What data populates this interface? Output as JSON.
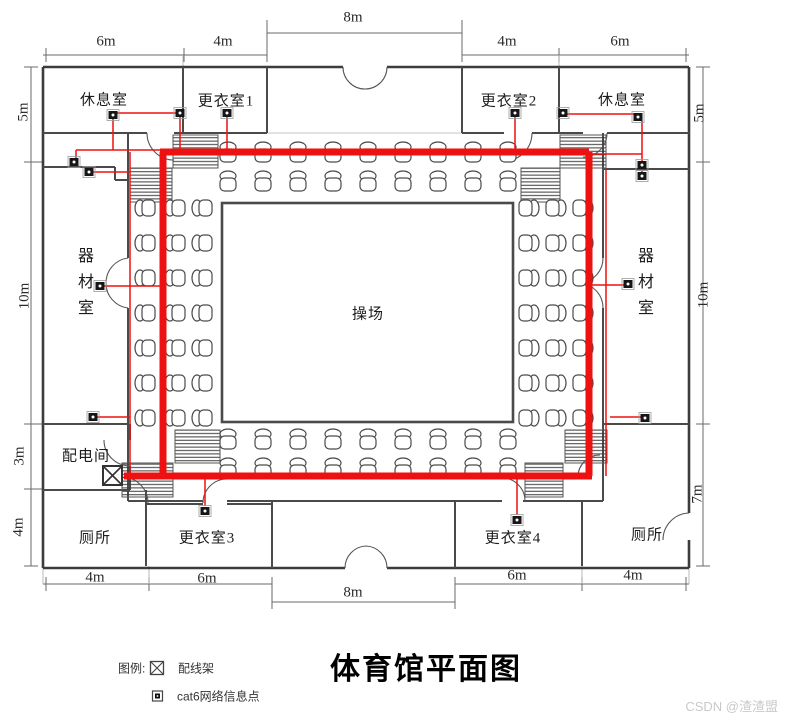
{
  "title": "体育馆平面图",
  "watermark": "CSDN @渣渣盟",
  "legend": {
    "heading": "图例:",
    "patch_panel_label": "配线架",
    "cat6_label": "cat6网络信息点"
  },
  "rooms": {
    "rest_room_tl": "休息室",
    "changing_room_1": "更衣室1",
    "changing_room_2": "更衣室2",
    "rest_room_tr": "休息室",
    "equipment_room_left": "器材室",
    "equipment_room_right": "器材室",
    "playground": "操场",
    "power_room": "配电间",
    "toilet_left": "厕所",
    "changing_room_3": "更衣室3",
    "changing_room_4": "更衣室4",
    "toilet_right": "厕所"
  },
  "dimensions": {
    "top_8m": "8m",
    "top_left_6m": "6m",
    "top_left_4m": "4m",
    "top_right_4m": "4m",
    "top_right_6m": "6m",
    "left_5m": "5m",
    "left_10m": "10m",
    "left_3m": "3m",
    "left_4m": "4m",
    "right_5m": "5m",
    "right_10m": "10m",
    "right_7m": "7m",
    "bottom_left_4m": "4m",
    "bottom_left_6m": "6m",
    "bottom_8m": "8m",
    "bottom_right_6m": "6m",
    "bottom_right_4m": "4m"
  },
  "cabling": {
    "color": "#ee1111",
    "backbone": "M163,476 V152 M160,152 H589 M589,152 V476 M592,476 H124",
    "branches": [
      "M76,150 H163",
      "M76,150 V158",
      "M113,150 V118",
      "M116,113 H177",
      "M180,116 V150",
      "M227,117 V150",
      "M92,172 H130",
      "M130,152 V476",
      "M104,286 H160",
      "M96,417 H130",
      "M515,117 V150",
      "M567,114 H634",
      "M642,121 V172",
      "M592,154 H642",
      "M606,170 V476",
      "M592,285 H624",
      "M610,417 H641",
      "M205,478 V506",
      "M517,478 V515"
    ]
  },
  "network_points": [
    [
      113,
      115
    ],
    [
      180,
      113
    ],
    [
      227,
      113
    ],
    [
      74,
      162
    ],
    [
      89,
      172
    ],
    [
      100,
      286
    ],
    [
      93,
      417
    ],
    [
      515,
      113
    ],
    [
      563,
      113
    ],
    [
      638,
      117
    ],
    [
      642,
      165
    ],
    [
      642,
      176
    ],
    [
      628,
      284
    ],
    [
      645,
      418
    ],
    [
      205,
      511
    ],
    [
      517,
      520
    ]
  ],
  "colors": {
    "wall": "#3c3c3c",
    "partition": "#4a4a4a",
    "cable": "#ee1111",
    "dimension": "#666666",
    "watermark": "#c9c9c9"
  }
}
